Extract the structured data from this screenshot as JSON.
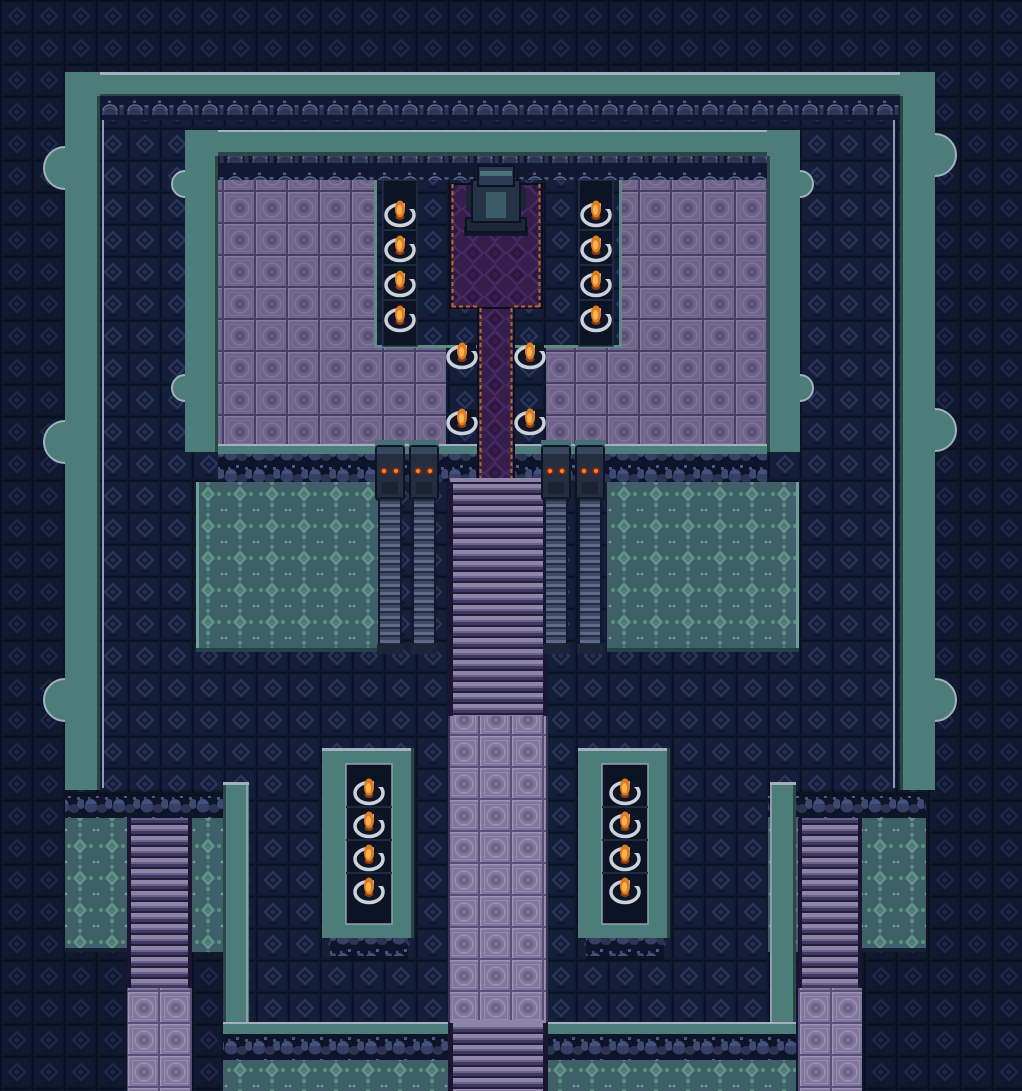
{
  "scene": {
    "environment": "dark-temple-interior",
    "view": "top-down-tile-map",
    "tile_size_px": 32,
    "canvas": {
      "width": 1022,
      "height": 1091
    }
  },
  "palette": {
    "wall_teal": "#4d7d78",
    "wall_highlight": "#a2b0c0",
    "wall_shadow": "#2b4644",
    "background_tile": "#111930",
    "court_tile": "#161f3a",
    "floor_tile_purple": "#6e6488",
    "walkway_tile": "#80769a",
    "patterned_wall_teal": "#3f5f69",
    "carpet_purple": "#361d4a",
    "carpet_gold_trim": "#a87126",
    "stair_step": "#8e84a8",
    "torch_flame": "#e07c20",
    "torch_flame_core": "#f9b254",
    "torch_ring": "#ccd2dc",
    "pillar_eye": "#e8862c"
  },
  "objects": {
    "altar_statue": {
      "x": 496,
      "y": 200
    },
    "grand_staircase": {
      "x": 450,
      "y": 480,
      "width": 96,
      "height": 236
    },
    "bottom_exit_staircase": {
      "x": 450,
      "y": 1022,
      "width": 96,
      "height": 69
    },
    "side_staircase_left": {
      "x": 127,
      "y": 818,
      "width": 65,
      "height": 170
    },
    "side_staircase_right": {
      "x": 800,
      "y": 818,
      "width": 62,
      "height": 170
    },
    "torch_panel_left": {
      "x": 322,
      "y": 748
    },
    "torch_panel_right": {
      "x": 578,
      "y": 748
    },
    "carpet": {
      "wide": {
        "x": 450,
        "y": 184,
        "w": 92,
        "h": 124
      },
      "runner": {
        "x": 478,
        "y": 308,
        "w": 36,
        "h": 174
      }
    }
  },
  "torches": {
    "count": 20,
    "items": [
      {
        "x": 400,
        "y": 212
      },
      {
        "x": 400,
        "y": 247
      },
      {
        "x": 400,
        "y": 282
      },
      {
        "x": 400,
        "y": 317
      },
      {
        "x": 596,
        "y": 212
      },
      {
        "x": 596,
        "y": 247
      },
      {
        "x": 596,
        "y": 282
      },
      {
        "x": 596,
        "y": 317
      },
      {
        "x": 462,
        "y": 354
      },
      {
        "x": 530,
        "y": 354
      },
      {
        "x": 462,
        "y": 420
      },
      {
        "x": 530,
        "y": 420
      },
      {
        "x": 369,
        "y": 790
      },
      {
        "x": 369,
        "y": 823
      },
      {
        "x": 369,
        "y": 856
      },
      {
        "x": 369,
        "y": 889
      },
      {
        "x": 625,
        "y": 790
      },
      {
        "x": 625,
        "y": 823
      },
      {
        "x": 625,
        "y": 856
      },
      {
        "x": 625,
        "y": 889
      }
    ]
  },
  "pillars": {
    "column_centers_x": [
      390,
      424,
      556,
      590
    ],
    "eye_color": "#e8862c"
  },
  "buttresses": {
    "outer_left_cy": [
      168,
      442,
      700
    ],
    "outer_right_cy": [
      155,
      430,
      700
    ],
    "hall_cy": [
      184,
      388
    ],
    "outer_radius": 21,
    "hall_radius": 13
  }
}
